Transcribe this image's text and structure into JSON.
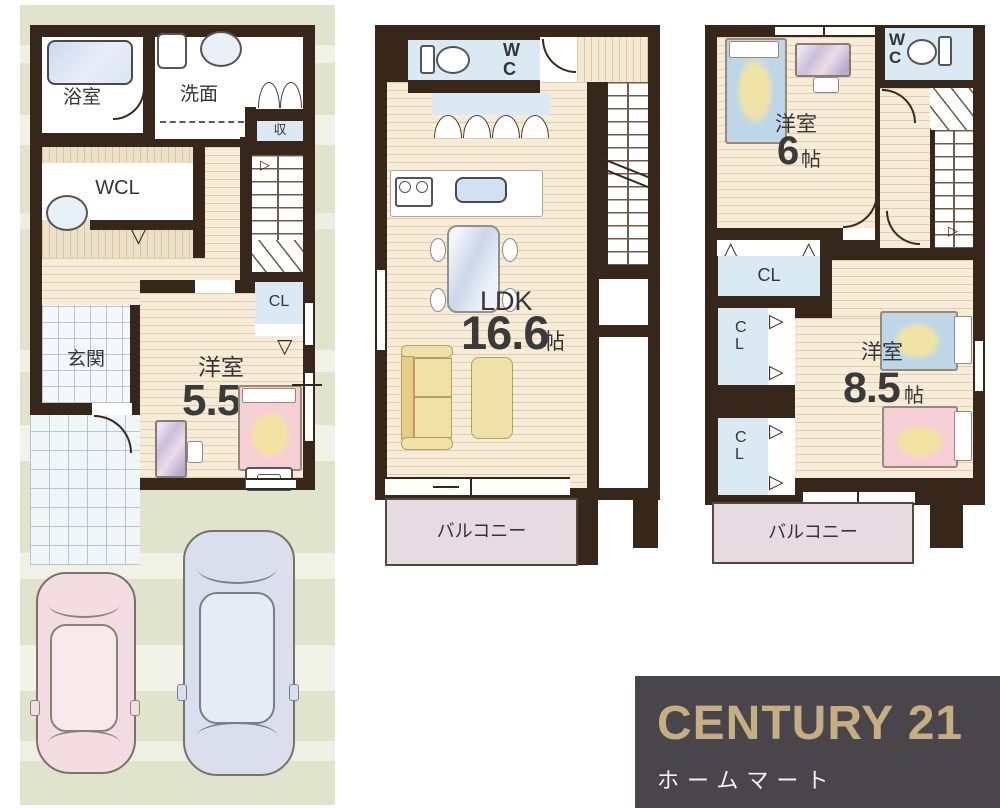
{
  "floor1": {
    "bath_label": "浴室",
    "wash_label": "洗面",
    "storage_label": "収",
    "wcl_label": "WCL",
    "closet_label": "CL",
    "genkan_label": "玄関",
    "room_name": "洋室",
    "room_size": "5.5",
    "size_unit": "帖"
  },
  "floor2": {
    "wc_label": "WC",
    "room_name": "LDK",
    "room_size": "16.6",
    "size_unit": "帖",
    "balcony_label": "バルコニー"
  },
  "floor3": {
    "wc_label": "WC",
    "closet_label": "CL",
    "room1_name": "洋室",
    "room1_size": "6",
    "room2_name": "洋室",
    "room2_size": "8.5",
    "size_unit": "帖",
    "balcony_label": "バルコニー"
  },
  "logo": {
    "brand": "CENTURY 21",
    "subtitle": "ホームマート"
  },
  "colors": {
    "wall": "#37261a",
    "wood_floor": "#f6ecd7",
    "water_blue": "#daeaf5",
    "balcony_pink": "#e5dbe0",
    "site_green": "#e0e4cd",
    "logo_bg": "#48464b",
    "logo_gold": "#c6ae80"
  }
}
